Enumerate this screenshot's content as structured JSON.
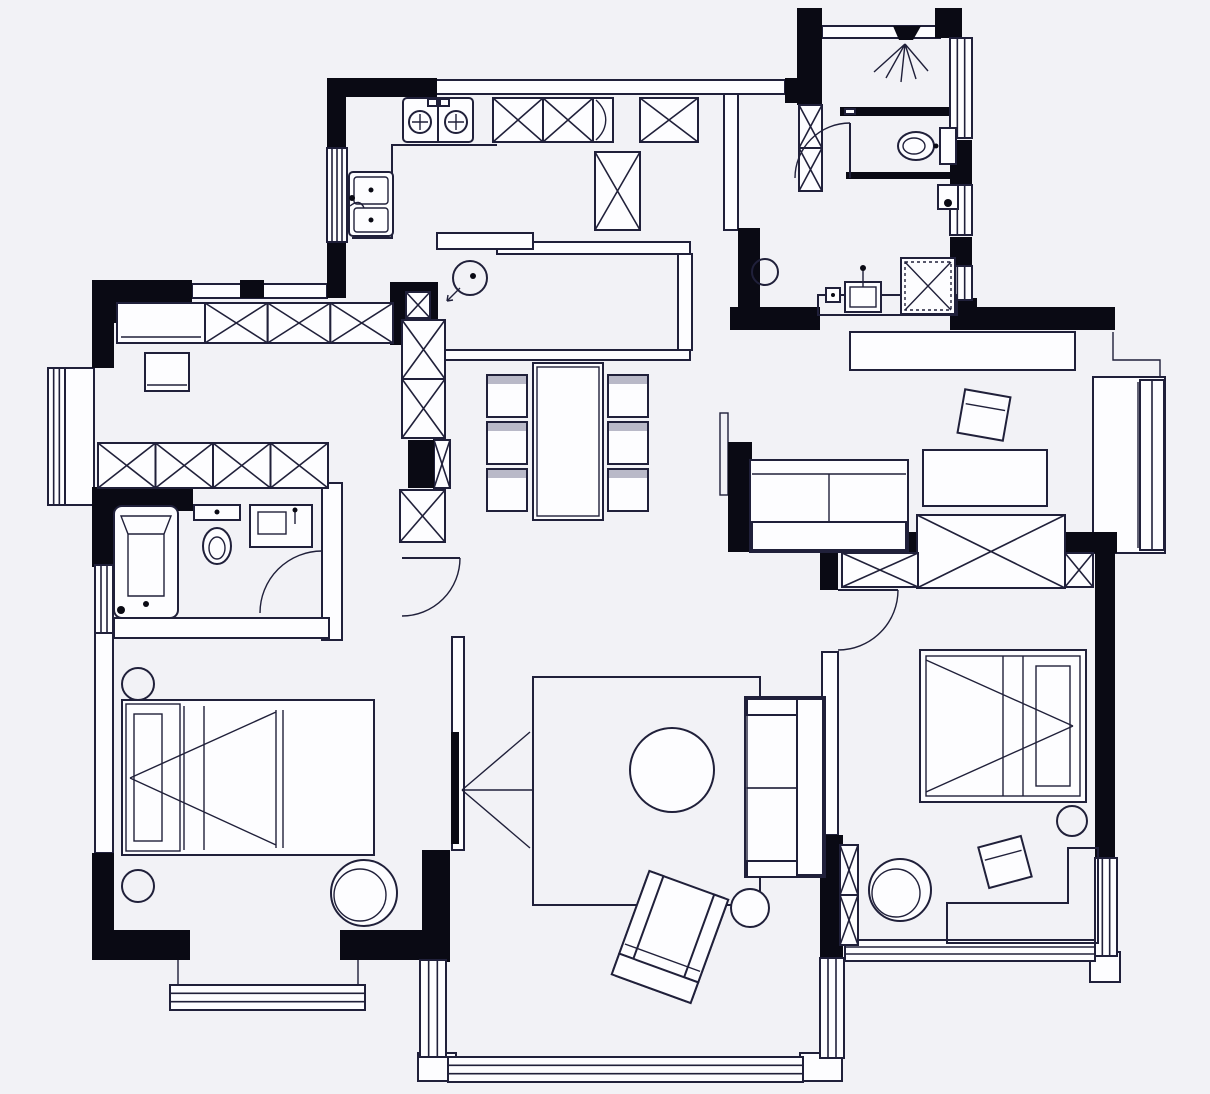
{
  "meta": {
    "kind": "architectural-floor-plan",
    "style": "black-and-white line drawing"
  },
  "colors": {
    "background": "#f2f2f6",
    "surface": "#fdfdff",
    "line": "#20203a",
    "wall": "#0a0a14",
    "shade": "#b9b9c8"
  },
  "plan": {
    "rooms": [
      {
        "id": "kitchen",
        "icons": [
          "stove-two-burners-icon",
          "double-sink-icon",
          "counter-icon",
          "tall-cabinet-icon"
        ]
      },
      {
        "id": "entry-hall",
        "icons": [
          "wardrobe-x-cabinets-icon",
          "shoe-cabinet-icon",
          "side-table-icon"
        ]
      },
      {
        "id": "shower-bathroom-top",
        "icons": [
          "shower-head-icon",
          "toilet-icon",
          "door-swing-icon",
          "glass-partition-icon"
        ]
      },
      {
        "id": "laundry-corridor",
        "icons": [
          "washing-machine-icon",
          "laundry-sink-icon",
          "ceiling-light-icon",
          "counter-icon"
        ]
      },
      {
        "id": "dressing-room",
        "icons": [
          "wardrobe-x-row-icon",
          "wardrobe-x-row-icon",
          "stool-icon",
          "bay-window-icon"
        ]
      },
      {
        "id": "bathroom-left",
        "icons": [
          "bathtub-icon",
          "toilet-icon",
          "vanity-sink-icon",
          "door-swing-icon"
        ]
      },
      {
        "id": "bedroom-left",
        "icons": [
          "double-bed-icon",
          "nightstand-icon",
          "nightstand-icon",
          "round-ottoman-icon",
          "bay-window-icon"
        ]
      },
      {
        "id": "dining-area",
        "icons": [
          "dining-table-icon",
          "chair-icon",
          "chair-icon",
          "chair-icon",
          "chair-icon",
          "chair-icon",
          "chair-icon"
        ]
      },
      {
        "id": "living-room",
        "icons": [
          "rug-icon",
          "round-coffee-table-icon",
          "sofa-icon",
          "armchair-icon",
          "side-round-table-icon",
          "tv-projection-icon",
          "panorama-window-icon"
        ]
      },
      {
        "id": "tv-lounge-right",
        "icons": [
          "sofa-icon",
          "tv-tilted-icon",
          "tv-cabinet-icon",
          "wardrobe-x-icon",
          "bay-window-icon"
        ]
      },
      {
        "id": "bedroom-right",
        "icons": [
          "double-bed-icon",
          "nightstand-icon",
          "round-chair-icon",
          "tilted-table-icon",
          "corner-desk-icon",
          "wardrobe-x-icon",
          "door-swing-icon"
        ]
      }
    ],
    "doors": [
      "hall-door",
      "bathroom-left-door",
      "bathroom-top-door",
      "bedroom-right-door"
    ],
    "window_count": 13,
    "wardrobe_x_box_count": 15
  }
}
